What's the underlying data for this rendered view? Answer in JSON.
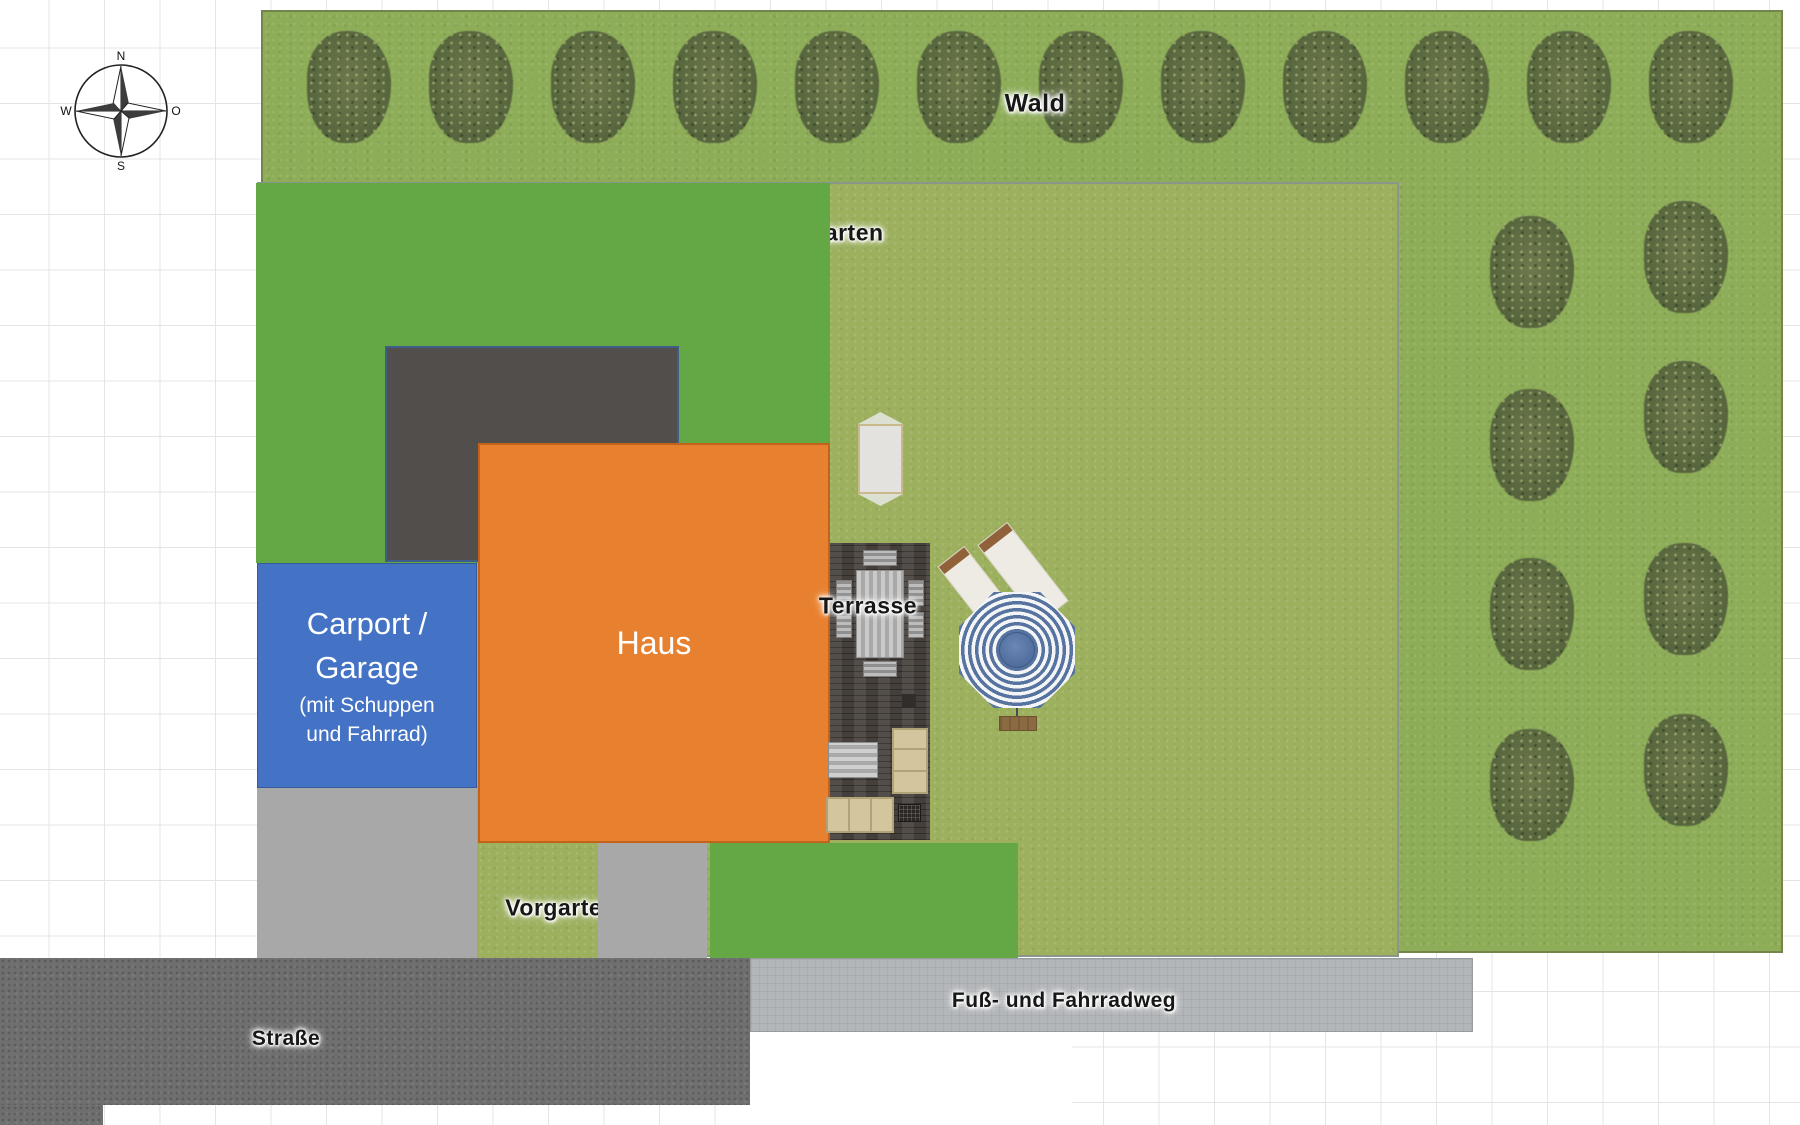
{
  "plan": {
    "compass": {
      "north": "N",
      "south": "S",
      "west": "W",
      "east": "O"
    },
    "areas": {
      "wald": {
        "label": "Wald"
      },
      "garten": {
        "label": "Garten"
      },
      "haus": {
        "label": "Haus"
      },
      "carport": {
        "line1": "Carport /",
        "line2": "Garage",
        "line3": "(mit Schuppen",
        "line4": "und Fahrrad)"
      },
      "terrasse": {
        "label": "Terrasse"
      },
      "vorgarten": {
        "label": "Vorgarten"
      },
      "strasse": {
        "label": "Straße"
      },
      "fussweg": {
        "label": "Fuß- und Fahrradweg"
      }
    },
    "colors": {
      "carport_blue": "#4472C4",
      "haus_orange": "#E8812F",
      "flat_green": "#64A846",
      "drive_dark_gray": "#524E4B",
      "sidewalk_gray": "#A8A8A8",
      "street_gray": "#6F6F6F",
      "bikepath_gray": "#B3B6B9",
      "garden_green": "#9CB05E",
      "forest_green": "#8EAD58",
      "terrace_brown": "#4B4540",
      "parasol_blue": "#56749F",
      "sofa_beige": "#D3C59D"
    }
  }
}
